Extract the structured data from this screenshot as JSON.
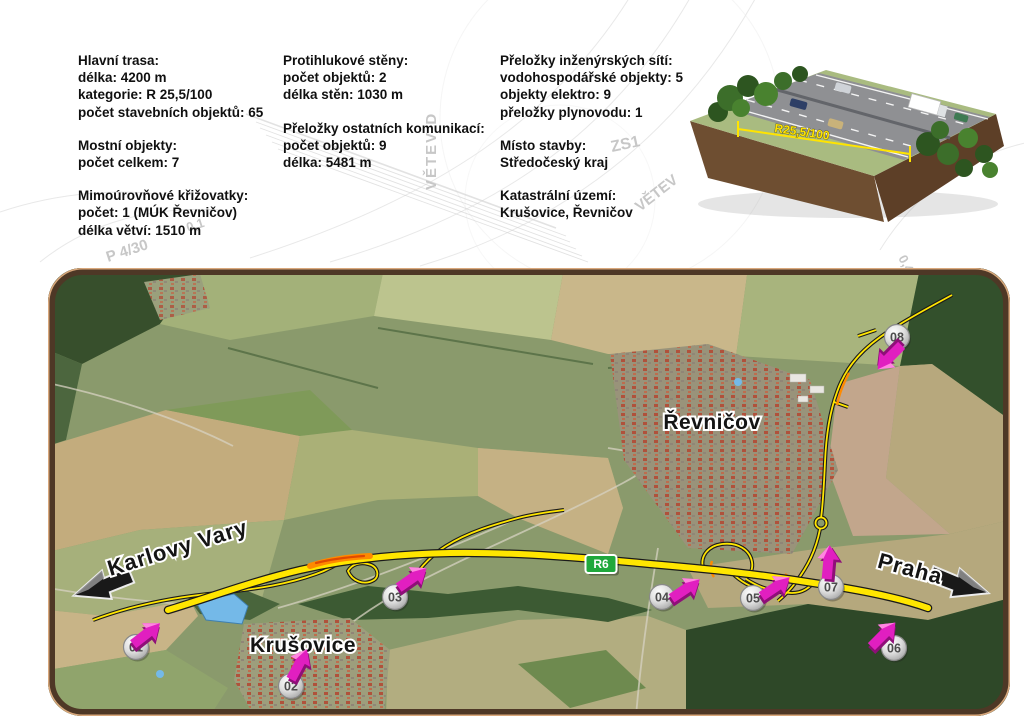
{
  "background": {
    "texts": {
      "vetev_d": "VĚTEV D",
      "zs1": "ZS1",
      "vetev": "VĚTEV",
      "p430": "P 4/30",
      "n01": "0,1",
      "n04": "0,4"
    }
  },
  "info_panel": {
    "columns": [
      {
        "blocks": [
          [
            "Hlavní trasa:",
            "délka: 4200 m",
            "kategorie: R 25,5/100",
            "počet stavebních objektů: 65"
          ],
          [
            "Mostní objekty:",
            "počet celkem: 7"
          ],
          [
            "Mimoúrovňové křižovatky:",
            "počet: 1 (MÚK Řevničov)",
            "délka větví: 1510 m"
          ]
        ]
      },
      {
        "blocks": [
          [
            "Protihlukové stěny:",
            "počet objektů: 2",
            "délka stěn: 1030 m"
          ],
          [
            "Přeložky ostatních komunikací:",
            "počet objektů: 9",
            "délka: 5481 m"
          ]
        ]
      },
      {
        "blocks": [
          [
            "Přeložky inženýrských sítí:",
            "vodohospodářské objekty: 5",
            "objekty elektro: 9",
            "přeložky plynovodu: 1"
          ],
          [
            "Místo stavby:",
            "Středočeský kraj"
          ],
          [
            "Katastrální území:",
            "Krušovice, Řevničov"
          ]
        ]
      }
    ]
  },
  "illustration": {
    "dimension_label": "R25,5/100"
  },
  "map": {
    "route_badge": "R6",
    "towns": {
      "revnicov": "Řevničov",
      "krusovice": "Krušovice"
    },
    "directions": {
      "west": "Karlovy Vary",
      "east": "Praha"
    },
    "markers": [
      {
        "id": "01"
      },
      {
        "id": "02"
      },
      {
        "id": "03"
      },
      {
        "id": "04"
      },
      {
        "id": "05"
      },
      {
        "id": "06"
      },
      {
        "id": "07"
      },
      {
        "id": "08"
      }
    ],
    "colors": {
      "route_yellow": "#FFE600",
      "route_orange": "#FF8A00",
      "construction_red": "#E04A00",
      "marker_arrow_magenta": "#E11FC0",
      "badge_green": "#1FA83C",
      "map_border_brown": "#4E3826"
    }
  }
}
